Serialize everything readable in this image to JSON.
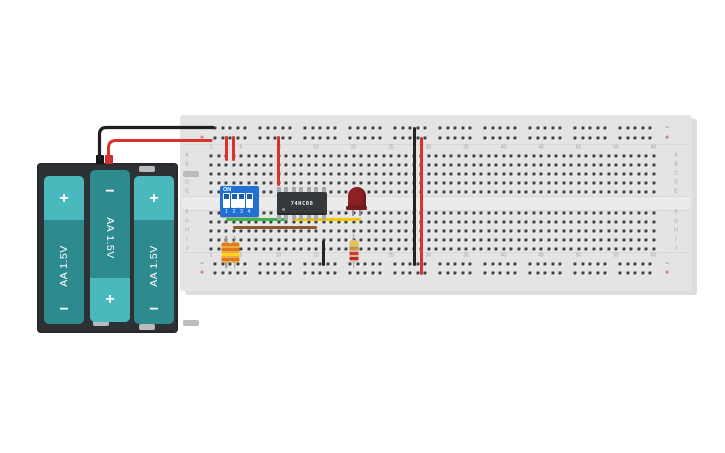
{
  "battery_pack": {
    "name": "3x AA battery holder",
    "case_color": "#2e3134",
    "cell_body_color": "#2d8a8f",
    "cell_cap_color": "#4ab9be",
    "negative_lead_color": "#1f1f1f",
    "positive_lead_color": "#d8342e",
    "cells": [
      {
        "label": "AA 1.5V",
        "top": "+",
        "bottom": "−"
      },
      {
        "label": "AA 1.5V",
        "top": "−",
        "bottom": "+"
      },
      {
        "label": "AA 1.5V",
        "top": "+",
        "bottom": "−"
      }
    ]
  },
  "breadboard": {
    "board_color": "#e4e4e4",
    "column_numbers": [
      1,
      5,
      10,
      15,
      20,
      25,
      30,
      35,
      40,
      45,
      50,
      55,
      60
    ],
    "row_letters_top": [
      "A",
      "B",
      "C",
      "D",
      "E"
    ],
    "row_letters_bottom": [
      "F",
      "G",
      "H",
      "I",
      "J"
    ],
    "rail_negative_symbol": "−",
    "rail_positive_symbol": "+",
    "rail_negative_color": "#6b9fd8",
    "rail_positive_color": "#d9534f"
  },
  "components": {
    "dip_switch": {
      "label": "ON",
      "positions": [
        "1",
        "2",
        "3",
        "4"
      ],
      "color": "#2170d4"
    },
    "ic": {
      "label": "74HC08",
      "color": "#35393c"
    },
    "led": {
      "color": "#8e2125"
    },
    "resistors": [
      {
        "body_color": "#eaa94e",
        "bands": [
          "orange",
          "orange",
          "yellow",
          "orange"
        ]
      },
      {
        "body_color": "#eaa94e",
        "bands": [
          "orange",
          "orange",
          "yellow",
          "orange"
        ]
      },
      {
        "body_color": "#d9b690",
        "bands": [
          "yellow",
          "gold",
          "red",
          "red"
        ]
      }
    ]
  },
  "wires": [
    {
      "name": "battery-negative-lead",
      "color": "#1f1f1f"
    },
    {
      "name": "battery-positive-lead",
      "color": "#d8342e"
    },
    {
      "name": "jumper-red-power-col3",
      "color": "#d8342e"
    },
    {
      "name": "jumper-red-power-col4",
      "color": "#d8342e"
    },
    {
      "name": "jumper-red-ic-vcc",
      "color": "#d8342e"
    },
    {
      "name": "jumper-green-switch-to-ic",
      "color": "#3cb54a"
    },
    {
      "name": "jumper-brown-switch-to-ic",
      "color": "#8b5a2b"
    },
    {
      "name": "jumper-yellow-ic-to-led",
      "color": "#f2c500"
    },
    {
      "name": "jumper-black-ic-gnd",
      "color": "#232323"
    },
    {
      "name": "rail-bridge-black",
      "color": "#232323"
    },
    {
      "name": "rail-bridge-red",
      "color": "#d8342e"
    }
  ]
}
